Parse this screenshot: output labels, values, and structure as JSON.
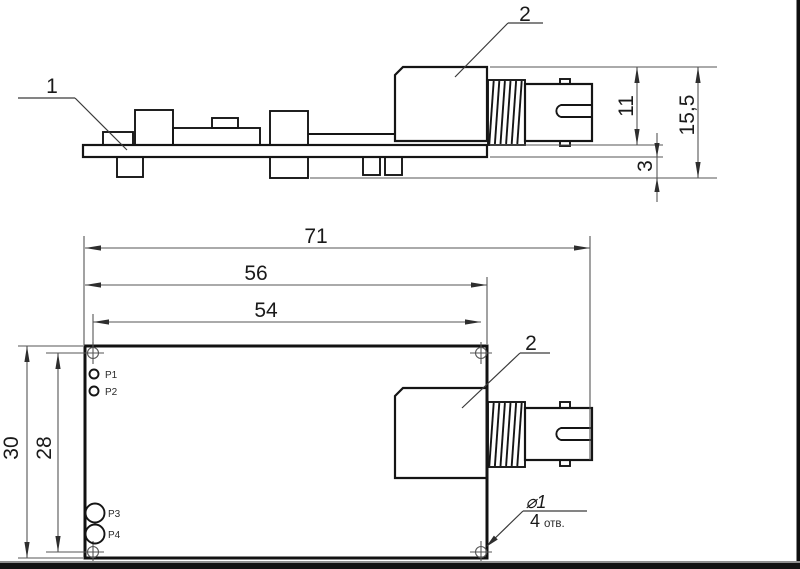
{
  "side_view": {
    "label_pcb": "1",
    "label_connector": "2",
    "dim_connector_height": "11",
    "dim_total_height": "15,5",
    "dim_pin_clearance": "3"
  },
  "plan_view": {
    "label_connector": "2",
    "dim_overall_length": "71",
    "dim_board_length": "56",
    "dim_hole_pitch_x": "54",
    "dim_board_width": "30",
    "dim_hole_pitch_y": "28",
    "test_points": {
      "p1": "P1",
      "p2": "P2",
      "p3": "P3",
      "p4": "P4"
    },
    "hole_callout": {
      "diameter": "⌀1",
      "count": "4",
      "unit": "отв."
    }
  },
  "colors": {
    "background": "#ffffff",
    "drawing_line": "#151515",
    "dimension_line": "#555555",
    "text": "#1a1a1a",
    "bottom_bar": "#121212",
    "bottom_bar_edge": "#909090",
    "right_border": "#0f0f0f"
  }
}
